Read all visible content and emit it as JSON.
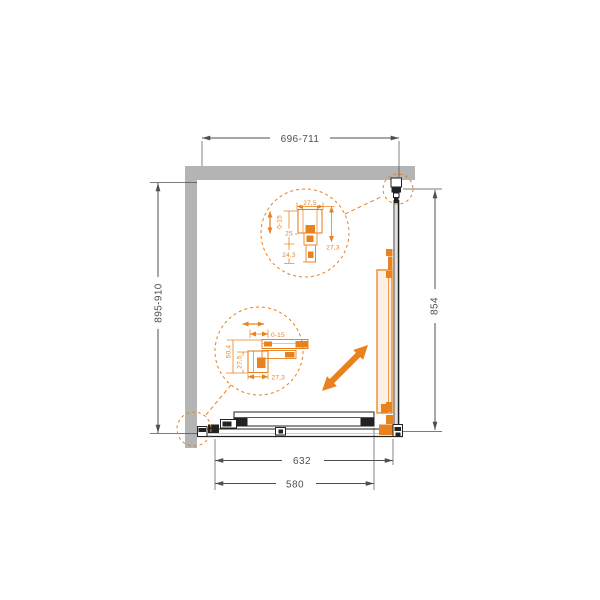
{
  "colors": {
    "accent_orange": "#E8821E",
    "wall_gray": "#B4B4B4",
    "dim_gray": "#4F4F4F",
    "profile_black": "#222222"
  },
  "dimensions": {
    "top_width": "696-711",
    "left_height": "895-910",
    "right_height": "854",
    "rail_width": "632",
    "glass_width": "580"
  },
  "detail_top": {
    "width": "27,5",
    "adjustment": "0-15",
    "inset_a": "25",
    "inset_b": "24,3",
    "depth": "27,3"
  },
  "detail_bottom": {
    "adjustment": "0-15",
    "height_outer": "50,4",
    "height_inner": "27,5",
    "width": "27,3"
  }
}
